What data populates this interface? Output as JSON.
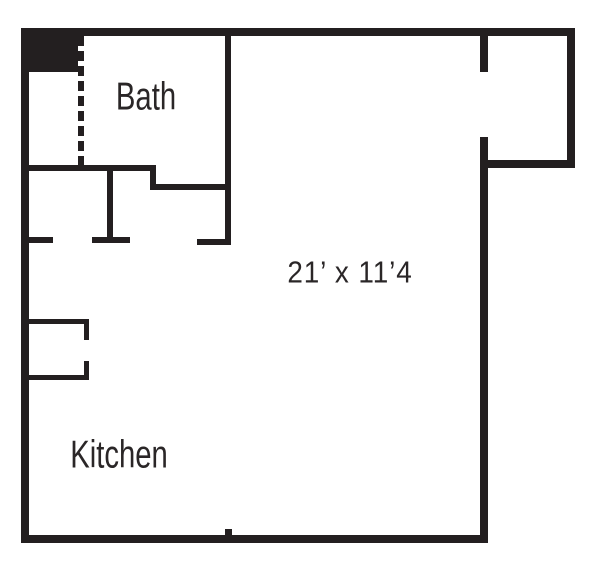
{
  "plan": {
    "type": "apartment-floor-plan",
    "rooms": [
      {
        "name": "bath",
        "label": "Bath"
      },
      {
        "name": "kitchen",
        "label": "Kitchen"
      },
      {
        "name": "main-room",
        "dimension_label": "21’ x 11’4"
      }
    ],
    "colors": {
      "wall": "#231f20",
      "background": "#ffffff",
      "label_text": "#2a2627"
    }
  }
}
